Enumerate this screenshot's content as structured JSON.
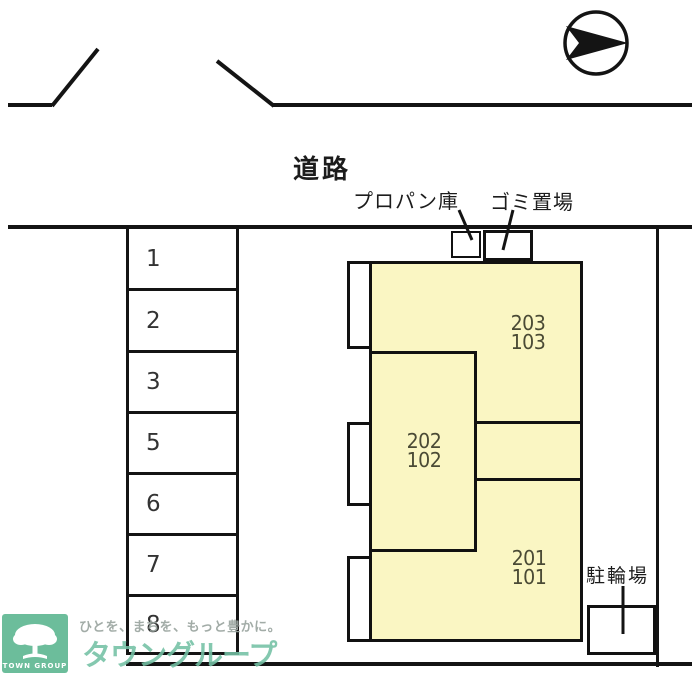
{
  "plan": {
    "road_label": "道路",
    "propane_label": "プロパン庫",
    "garbage_label": "ゴミ置場",
    "bicycle_label": "駐輪場",
    "parking_spaces": [
      "1",
      "2",
      "3",
      "5",
      "6",
      "7",
      "8"
    ],
    "units": [
      {
        "upper": "203",
        "lower": "103"
      },
      {
        "upper": "202",
        "lower": "102"
      },
      {
        "upper": "201",
        "lower": "101"
      }
    ],
    "compass_direction": "right"
  },
  "watermark": {
    "logo_text": "TOWN GROUP",
    "tagline": "ひとを、まちを、もっと豊かに。",
    "brand": "タウングループ"
  },
  "colors": {
    "line": "#141414",
    "building_fill": "#FAF6C3",
    "unit_text": "#4A4A35",
    "watermark_green": "#6CBD9B",
    "brand_green": "#74C1A5",
    "tagline_gray": "#9BA5A0"
  }
}
